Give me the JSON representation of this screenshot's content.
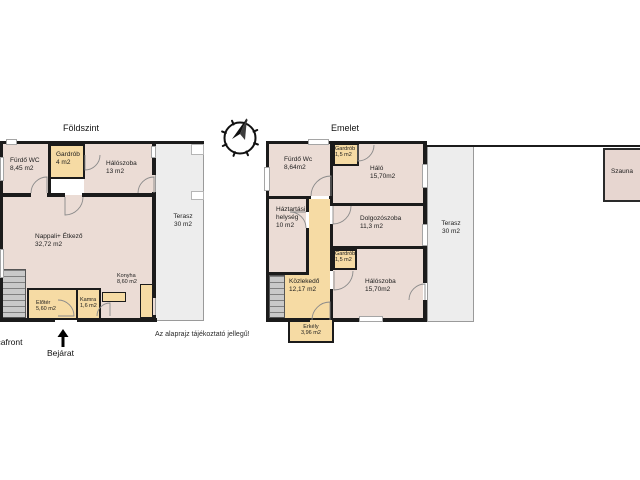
{
  "ground_floor": {
    "title": "Földszint",
    "rooms": {
      "furdo_wc": {
        "name": "Fürdő WC",
        "area": "8,45 m2"
      },
      "gardrob": {
        "name": "Gardrób",
        "area": "4 m2"
      },
      "haloszoba": {
        "name": "Hálószoba",
        "area": "13 m2"
      },
      "nappali_etkezo": {
        "name": "Nappali+ Étkező",
        "area": "32,72 m2"
      },
      "konyha": {
        "name": "Konyha",
        "area": "8,60 m2"
      },
      "eloter": {
        "name": "Előtér",
        "area": "5,60 m2"
      },
      "kamra": {
        "name": "Kamra",
        "area": "1,6 m2"
      },
      "terasz": {
        "name": "Terasz",
        "area": "30 m2"
      }
    },
    "street_label": "Utcafront",
    "entrance_label": "Bejárat"
  },
  "upper_floor": {
    "title": "Emelet",
    "rooms": {
      "furdo_wc": {
        "name": "Fürdő Wc",
        "area": "8,64m2"
      },
      "gardrob_top": {
        "name": "Gardrób",
        "area": "1,5 m2"
      },
      "halo": {
        "name": "Háló",
        "area": "15,70m2"
      },
      "haztartasi": {
        "name": "Háztartási helység",
        "area": "10 m2"
      },
      "dolgozoszoba": {
        "name": "Dolgozószoba",
        "area": "11,3 m2"
      },
      "gardrob_bottom": {
        "name": "Gardrób",
        "area": "1,5 m2"
      },
      "kozlekedo": {
        "name": "Közlekedő",
        "area": "12,17 m2"
      },
      "haloszoba": {
        "name": "Hálószoba",
        "area": "15,70m2"
      },
      "erkely": {
        "name": "Erkély",
        "area": "3,96 m2"
      },
      "terasz": {
        "name": "Terasz",
        "area": "30 m2"
      },
      "szauna": {
        "name": "Szauna"
      }
    }
  },
  "disclaimer": "Az alaprajz tájékoztató jellegű!",
  "colors": {
    "room_fill": "#ebdcd5",
    "highlight_fill": "#f6dba4",
    "terrace_fill": "#ededed",
    "sauna_fill": "#e7d6d0",
    "wall": "#1b1b1b",
    "stairs_fill": "#c9c9c9"
  }
}
